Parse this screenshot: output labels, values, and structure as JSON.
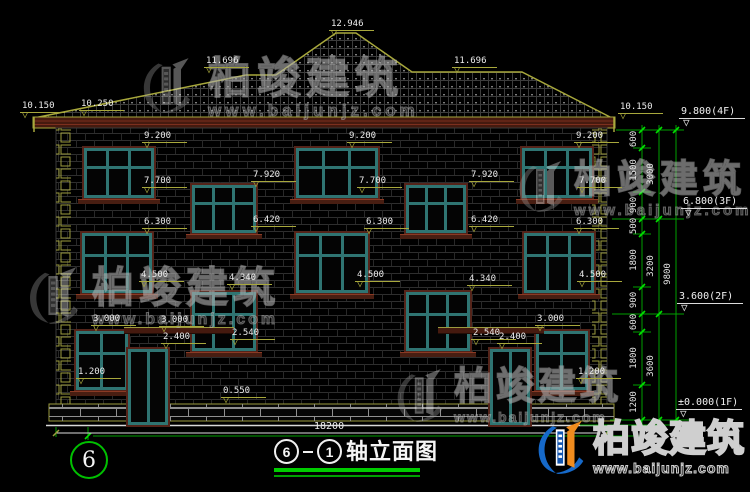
{
  "axis": {
    "bubble": "6"
  },
  "title": {
    "axis_from": "6",
    "axis_to": "1",
    "text": "轴立面图"
  },
  "dims": {
    "total": "18200"
  },
  "chains": {
    "c1": [
      "600",
      "1500",
      "900",
      "500",
      "1800",
      "900",
      "600",
      "1800",
      "1200"
    ],
    "c2": [
      "3000",
      "3200",
      "3600"
    ],
    "c3": [
      "9800"
    ]
  },
  "floors": {
    "f4": "9.800(4F)",
    "f3": "6.800(3F)",
    "f2": "3.600(2F)",
    "f1": "±0.000(1F)"
  },
  "flags": {
    "roof_peak": "12.946",
    "ridge_left": "11.696",
    "ridge_right": "11.696",
    "eave_left": "10.150",
    "eave_slope_left": "10.250",
    "eave_right": "10.150",
    "f4_win_top_left": "9.200",
    "f4_win_top_center": "9.200",
    "f4_win_top_right": "9.200",
    "f4_win_bottom_left": "7.700",
    "f4_win_bottom_center": "7.700",
    "f4_win_bottom_right": "7.700",
    "stair_win_top_left": "7.920",
    "stair_win_top_right": "7.920",
    "stair_win_bottom_left": "6.420",
    "stair_win_bottom_right": "6.420",
    "f3_win_top_left": "6.300",
    "f3_win_top_center": "6.300",
    "f3_win_top_right": "6.300",
    "f3_win_bottom_left": "4.500",
    "f3_win_bottom_center": "4.500",
    "f3_win_bottom_right": "4.500",
    "stair2_win_top_left": "4.340",
    "stair2_win_top_right": "4.340",
    "stair2_win_bottom_left": "2.540",
    "stair2_win_bottom_right": "2.540",
    "f1_win_top_left": "3.000",
    "canopy_left": "3.000",
    "door_top_left": "2.400",
    "door_top_right": "2.400",
    "f1_win_top_right": "3.000",
    "f1_win_bottom_left": "1.200",
    "f1_win_bottom_right": "1.200",
    "plinth_top": "0.550"
  },
  "brand": {
    "company": "柏竣建筑",
    "website": "www.baijunjz.com"
  }
}
